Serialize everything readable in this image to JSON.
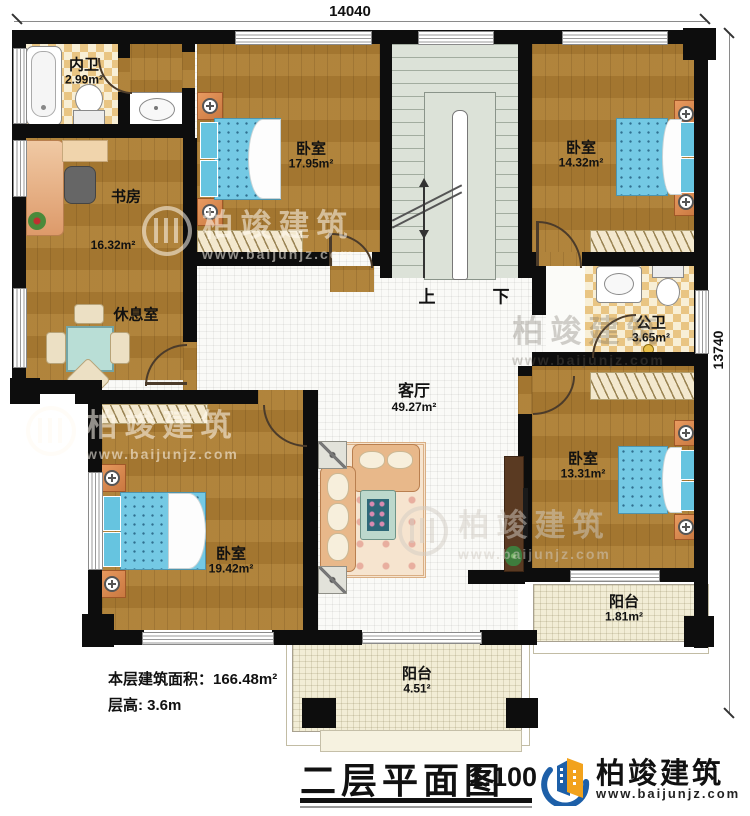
{
  "dimensions": {
    "width_top": "14040",
    "height_right": "13740"
  },
  "rooms": [
    {
      "name": "内卫",
      "area": "2.99m²"
    },
    {
      "name": "书房",
      "area": "16.32m²"
    },
    {
      "name": "休息室",
      "area": ""
    },
    {
      "name": "卧室",
      "area": "17.95m²"
    },
    {
      "name": "卧室",
      "area": "14.32m²"
    },
    {
      "name": "公卫",
      "area": "3.65m²"
    },
    {
      "name": "卧室",
      "area": "13.31m²"
    },
    {
      "name": "卧室",
      "area": "19.42m²"
    },
    {
      "name": "客厅",
      "area": "49.27m²"
    },
    {
      "name": "阳台",
      "area": "1.81m²"
    },
    {
      "name": "阳台",
      "area": "4.51²"
    }
  ],
  "stairs": {
    "up_label": "上",
    "down_label": "下"
  },
  "info": {
    "line1": "本层建筑面积：166.48m²",
    "line2": "层高: 3.6m"
  },
  "titleblock": {
    "title": "二层平面图",
    "scale": "1:100"
  },
  "logo": {
    "name": "柏竣建筑",
    "url": "www.baijunjz.com"
  },
  "watermark": {
    "name": "柏竣建筑",
    "url": "www.baijunjz.com"
  },
  "colors": {
    "wall": "#0d0d0d",
    "wood": "#aa7c34",
    "tile_checker": "#e9c583",
    "stair": "#dce2d8",
    "balcony": "#f2edd6",
    "bed": "#74c9e4",
    "logo_blue": "#1d5fa8",
    "logo_orange": "#f2a21c"
  }
}
